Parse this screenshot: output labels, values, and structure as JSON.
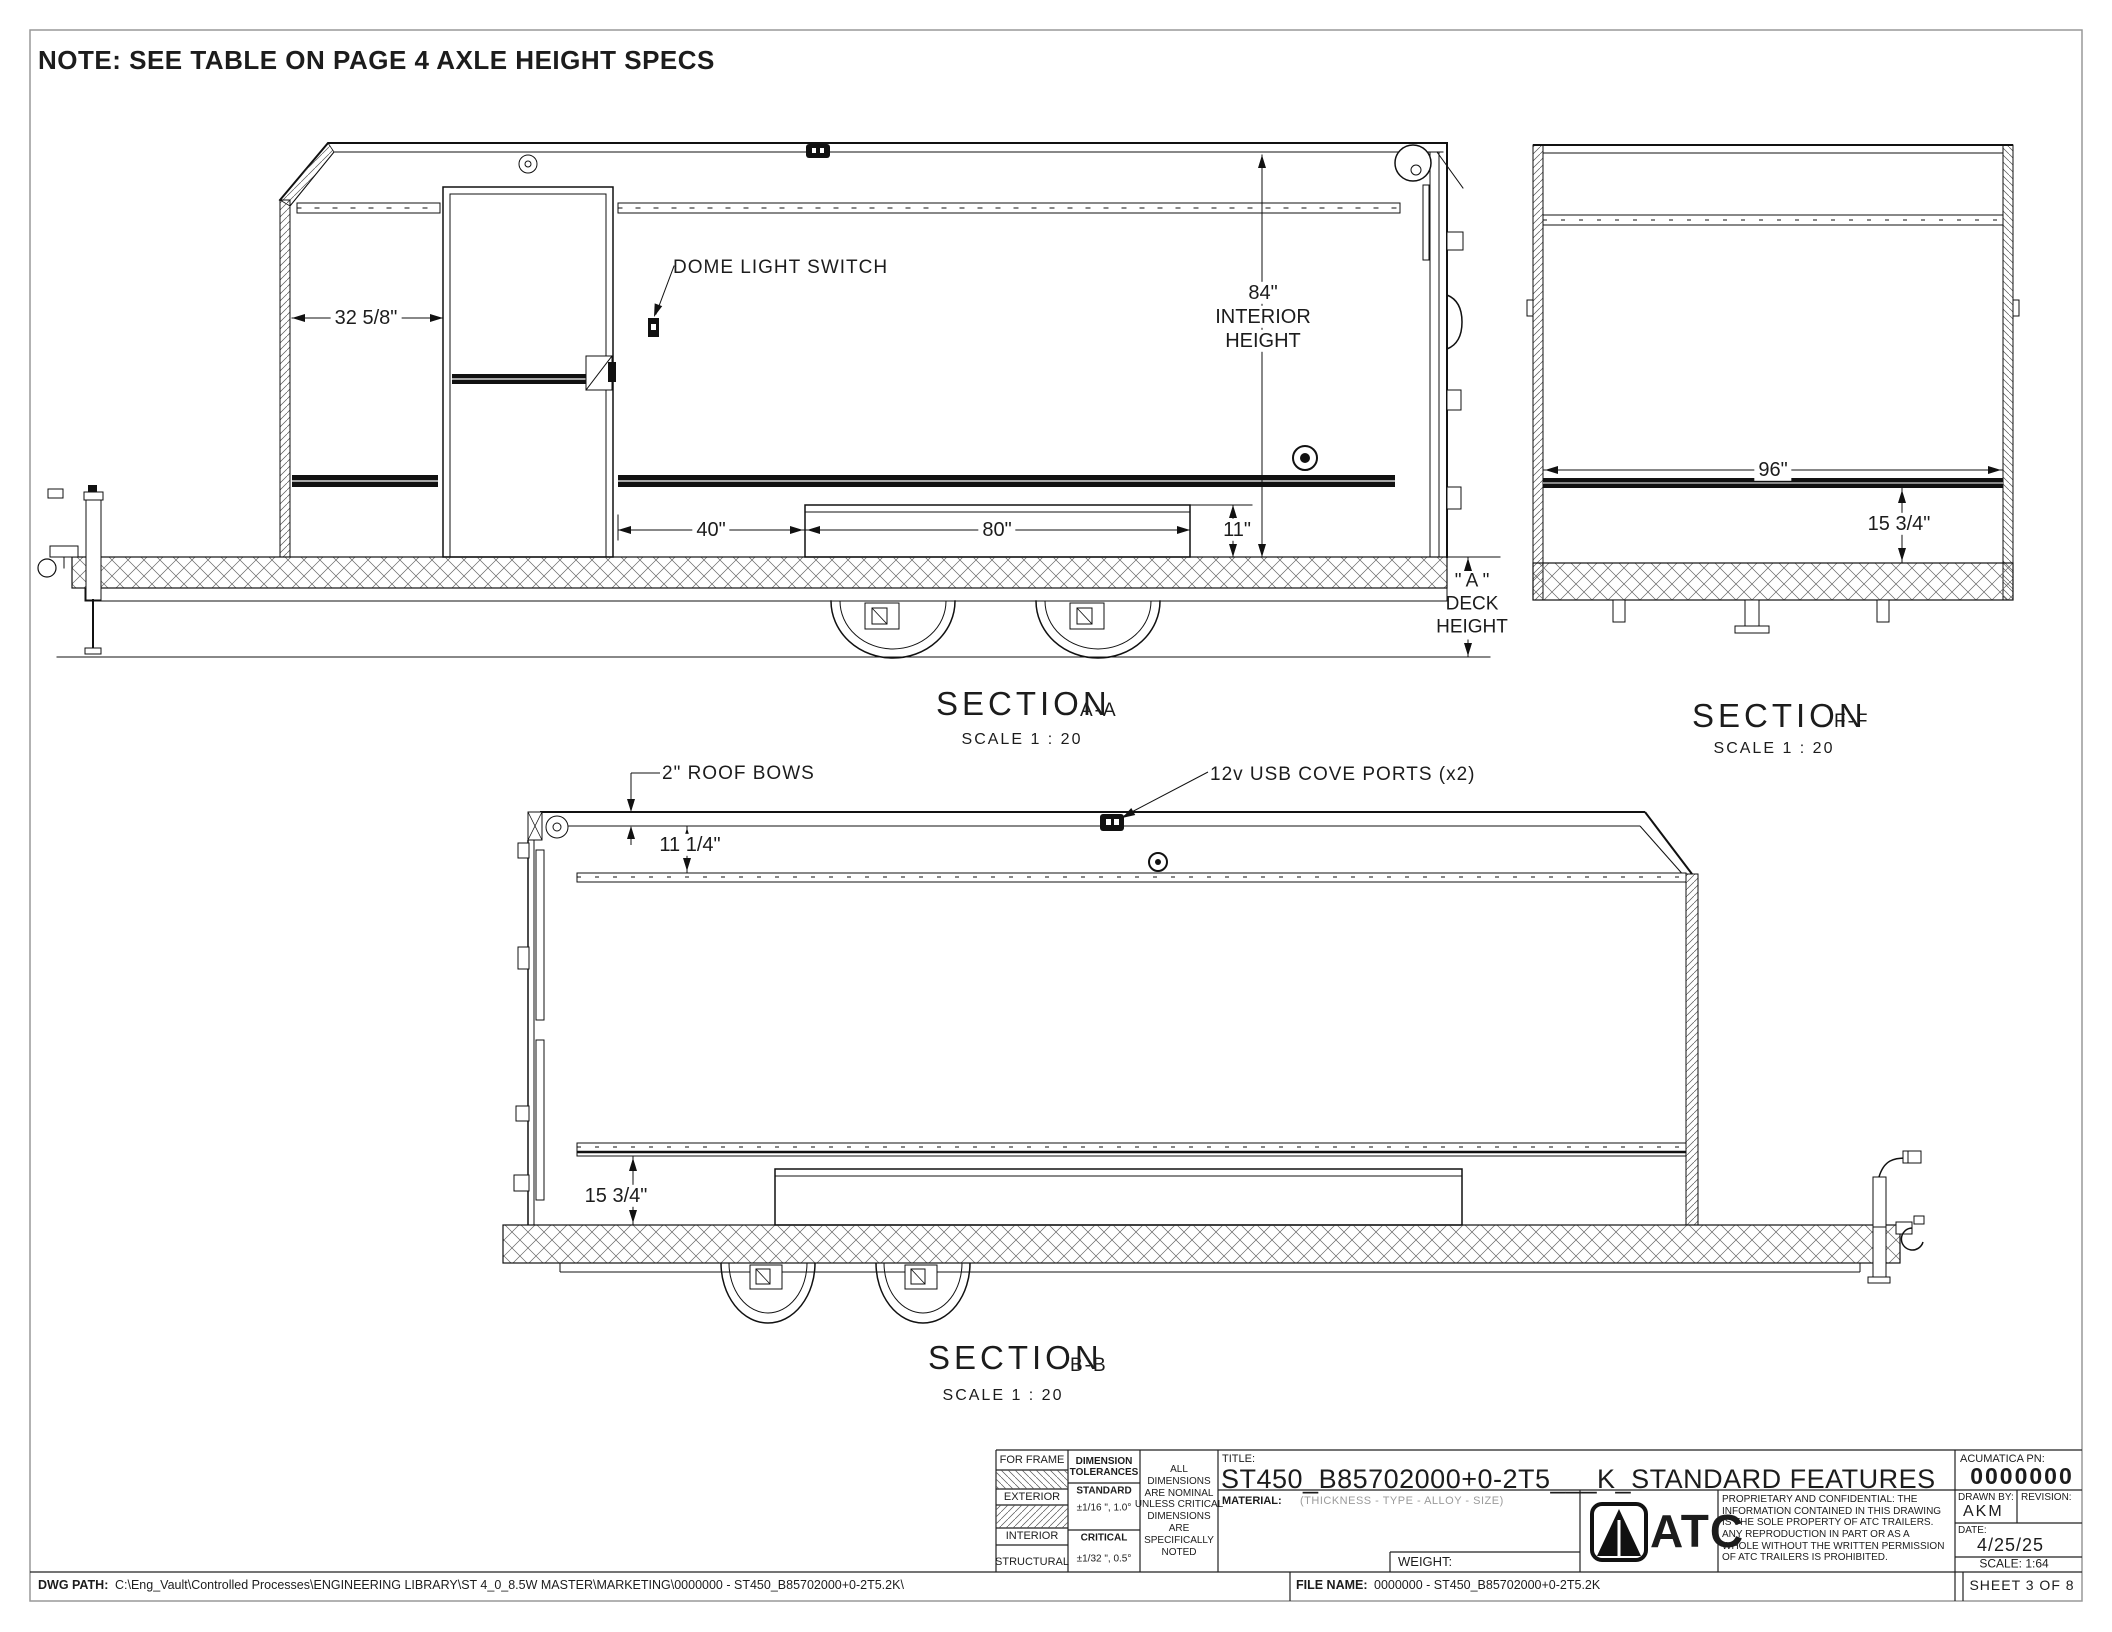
{
  "note": "NOTE: SEE TABLE ON PAGE 4 AXLE HEIGHT SPECS",
  "section_aa": {
    "name": "SECTION",
    "view": "A-A",
    "scale": "SCALE 1 : 20",
    "dim_front_to_door": "32 5/8\"",
    "label_dome_switch": "DOME LIGHT SWITCH",
    "dim_height": "84\"",
    "dim_height_l2": "INTERIOR",
    "dim_height_l3": "HEIGHT",
    "dim_door_to_box": "40\"",
    "dim_box_length": "80\"",
    "dim_box_height": "11\"",
    "deck_l1": "\" A \"",
    "deck_l2": "DECK",
    "deck_l3": "HEIGHT"
  },
  "section_ff": {
    "name": "SECTION",
    "view": "F-F",
    "scale": "SCALE 1 : 20",
    "dim_width": "96\"",
    "dim_rail_height": "15 3/4\""
  },
  "section_bb": {
    "name": "SECTION",
    "view": "B-B",
    "scale": "SCALE 1 : 20",
    "label_roof_bows": "2\" ROOF BOWS",
    "dim_bow_to_rail": "11 1/4\"",
    "label_usb": "12v USB COVE PORTS (x2)",
    "dim_rail_height": "15 3/4\""
  },
  "title_block": {
    "for_frame": "FOR FRAME",
    "exterior": "EXTERIOR",
    "interior": "INTERIOR",
    "structural": "STRUCTURAL",
    "tol_header": "DIMENSION\nTOLERANCES",
    "standard": "STANDARD",
    "standard_tol": "±1/16 \", 1.0°",
    "critical": "CRITICAL",
    "critical_tol": "±1/32 \", 0.5°",
    "nominal_note": "ALL\nDIMENSIONS\nARE NOMINAL\nUNLESS CRITICAL\nDIMENSIONS\nARE\nSPECIFICALLY\nNOTED",
    "title_label": "TITLE:",
    "title": "ST450_B85702000+0-2T5___K_STANDARD FEATURES",
    "material_label": "MATERIAL:",
    "material_value": "(THICKNESS - TYPE - ALLOY - SIZE)",
    "weight_label": "WEIGHT:",
    "logo_text": "ATC",
    "proprietary": "PROPRIETARY AND CONFIDENTIAL: THE\nINFORMATION CONTAINED IN THIS DRAWING\nIS THE SOLE PROPERTY OF ATC TRAILERS.\nANY REPRODUCTION IN PART OR AS A\nWHOLE WITHOUT THE WRITTEN PERMISSION\nOF ATC TRAILERS IS PROHIBITED.",
    "pn_label": "ACUMATICA PN:",
    "pn": "0000000",
    "drawn_by_label": "DRAWN BY:",
    "drawn_by": "AKM",
    "revision_label": "REVISION:",
    "date_label": "DATE:",
    "date": "4/25/25",
    "scale": "SCALE: 1:64",
    "sheet": "SHEET 3 OF 8"
  },
  "footer": {
    "dwg_path_label": "DWG PATH:",
    "dwg_path": "C:\\Eng_Vault\\Controlled Processes\\ENGINEERING LIBRARY\\ST 4_0_8.5W MASTER\\MARKETING\\0000000 - ST450_B85702000+0-2T5.2K\\",
    "file_label": "FILE NAME:",
    "file_name": "0000000 - ST450_B85702000+0-2T5.2K"
  }
}
